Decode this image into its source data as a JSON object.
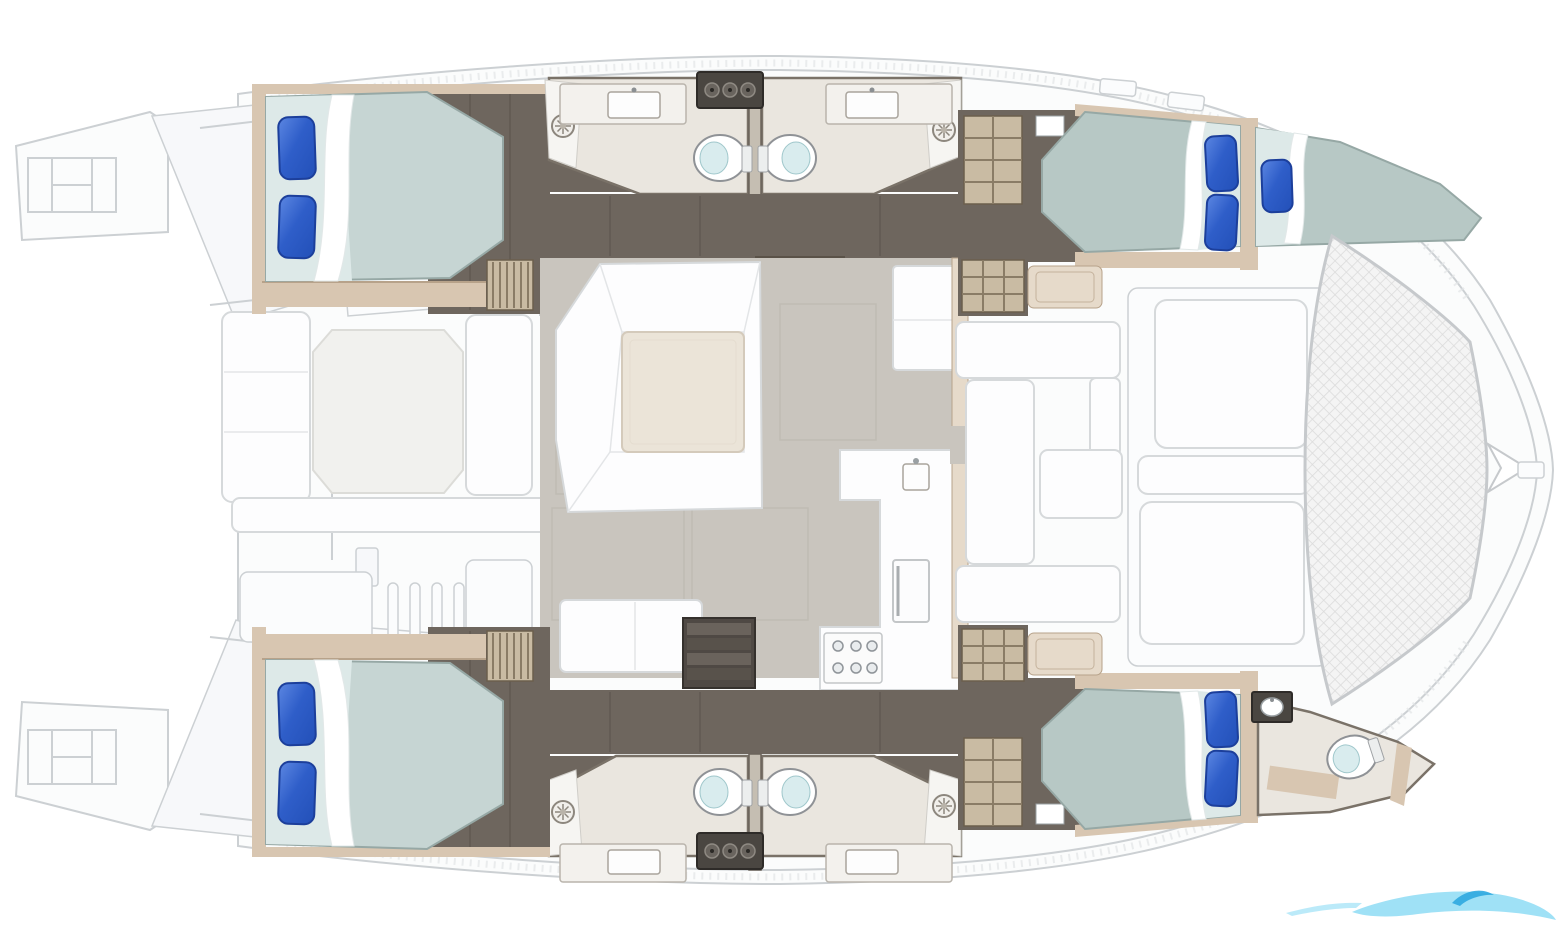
{
  "figure": {
    "type": "floorplan",
    "subject": "catamaran-accommodation-deck-plan",
    "orientation": "bow-right",
    "visible_text": ""
  },
  "colors": {
    "floor-dark": "#6e665e",
    "floor-dark2": "#59524b",
    "panel-dark": "#4a4641",
    "tan": "#d8c6b1",
    "tan-dark": "#b7a28a",
    "tan-light": "#e6daca",
    "grate": "#c9bba3",
    "floor-bath": "#eae6df",
    "bath-line": "#7a7268",
    "floor-saloon": "#c9c5be",
    "mattress": "#c6d5d3",
    "mattress-fore": "#b7c8c5",
    "mattress-head": "#dde9e8",
    "mattress-line": "#96a8a5",
    "pillow": "#2f5ec9",
    "pillow-dark": "#1c3f9b",
    "pillow-light": "#5c87e2",
    "white": "#fdfdfe",
    "white-line": "#d6d9db",
    "cream": "#ebe4d8",
    "toilet-seat": "#d9ecee",
    "line-faint": "#ccd0d3",
    "watermark-light": "#8edcf5",
    "watermark-accent": "#2ea8e0"
  },
  "areas": [
    {
      "id": "stern-platforms",
      "label": "Twin stern swim platforms with ladders"
    },
    {
      "id": "aft-cockpit",
      "label": "Aft cockpit with table and bench seating"
    },
    {
      "id": "cabin-aft-port",
      "label": "Aft double cabin, port hull"
    },
    {
      "id": "heads-port",
      "label": "Two facing bathrooms amidships, port hull"
    },
    {
      "id": "cabin-fore-port",
      "label": "Forward double cabin and V-berth, port hull"
    },
    {
      "id": "saloon-galley",
      "label": "Saloon with U-sofa, table and galley"
    },
    {
      "id": "heads-starboard",
      "label": "Two facing bathrooms amidships, starboard hull"
    },
    {
      "id": "cabin-aft-starboard",
      "label": "Aft double cabin, starboard hull"
    },
    {
      "id": "cabin-fore-starboard",
      "label": "Forward double cabin, starboard hull"
    },
    {
      "id": "head-fore-starboard",
      "label": "Forward bathroom, starboard hull"
    },
    {
      "id": "fwd-cockpit",
      "label": "Forward cockpit seating and sunpads"
    },
    {
      "id": "trampoline",
      "label": "Bow trampoline net"
    },
    {
      "id": "watermark",
      "label": "Light blue wave logo watermark"
    }
  ],
  "fixtures": {
    "double_beds": 4,
    "v_berths": 1,
    "pillows": 7,
    "toilets": 5,
    "bathroom_sinks": 5,
    "shower_heads": 4,
    "stove_burners": 6,
    "companionway_stairs": 2
  }
}
